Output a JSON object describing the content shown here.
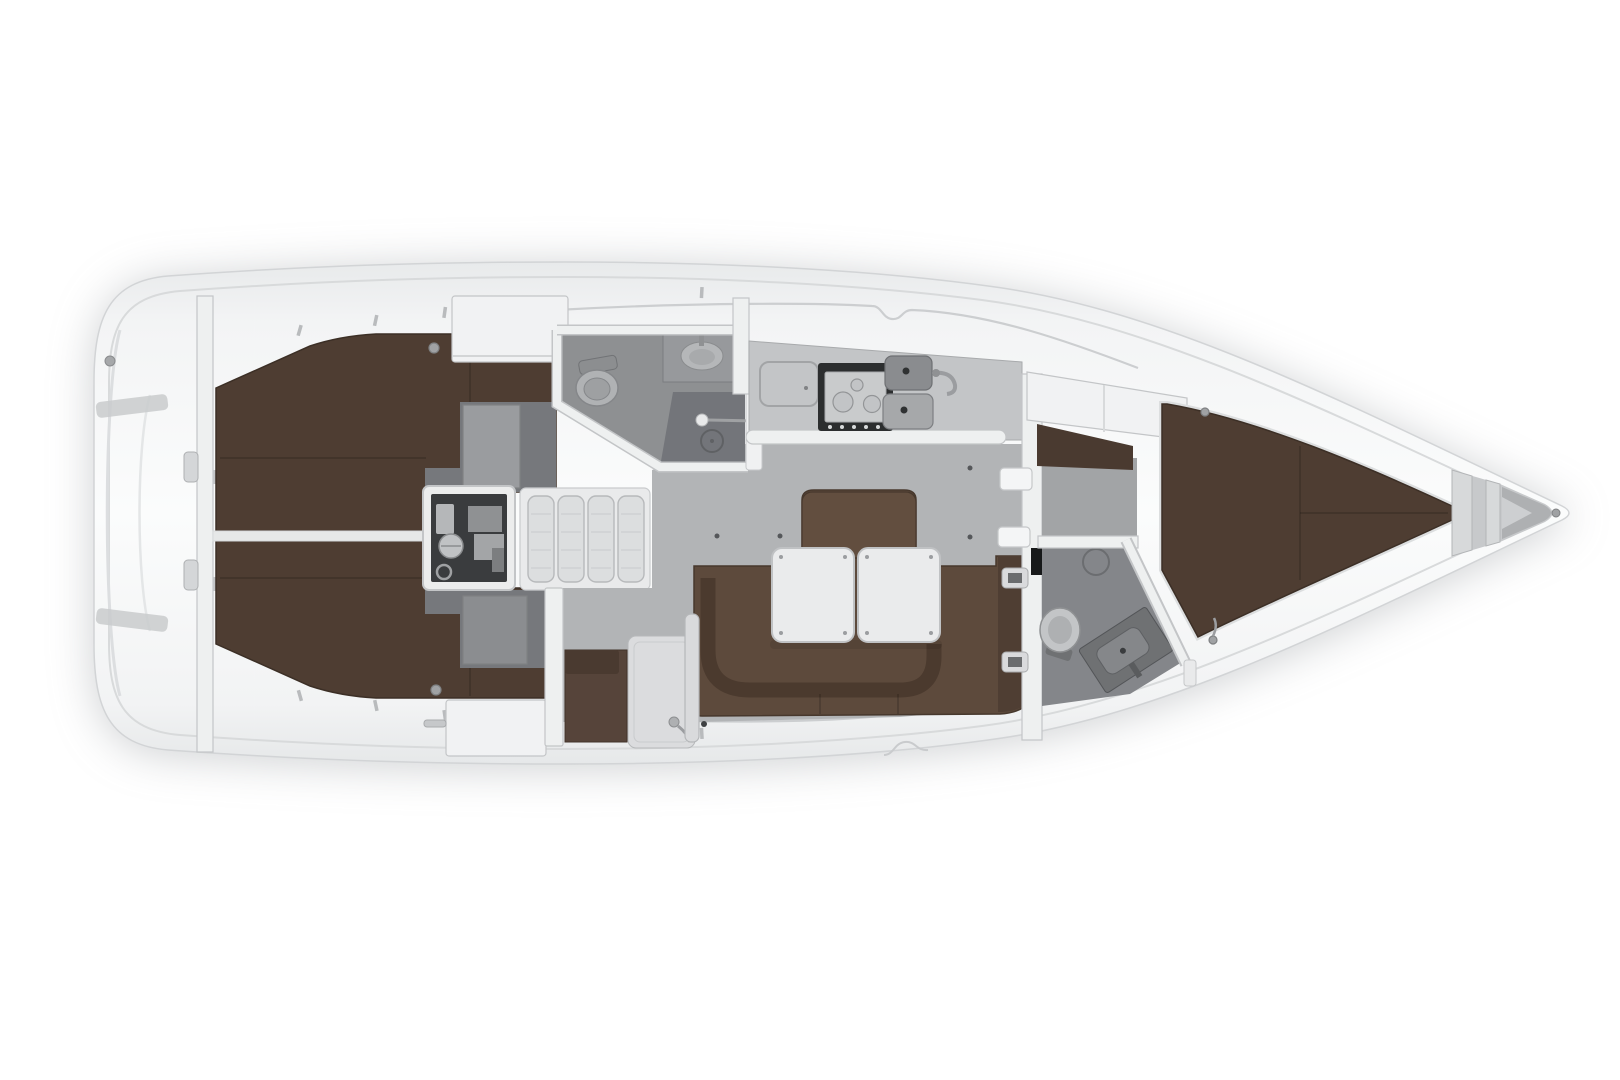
{
  "meta": {
    "description": "Top-down interior layout plan of a sailing yacht, bow pointing right, no text labels",
    "type": "yacht-interior-floor-plan"
  },
  "regions": [
    "swim-platform",
    "stern-bulkhead",
    "port-aft-cabin",
    "starboard-aft-cabin",
    "engine-compartment",
    "companionway-steps",
    "aft-head",
    "shower",
    "galley",
    "stove",
    "double-sink",
    "saloon",
    "u-settee",
    "dinette-table",
    "nav-station",
    "main-bulkhead",
    "forward-head",
    "forward-cabin",
    "v-berth",
    "anchor-locker",
    "bow-tip"
  ],
  "colors": {
    "background": "#ffffff",
    "hull_edge": "#d2d4d6",
    "inner_line": "#d8dadb",
    "deck_line": "#ccced0",
    "wall_fill": "#eef0f0",
    "wall_stroke": "#c3c5c7",
    "cabinet": "#f1f2f3",
    "berth": "#4e3d32",
    "berth_edge": "#3c2f26",
    "berth_rim": "#dcdedf",
    "divider": "#e6e8e8",
    "corridor_dark": "#76787c",
    "door_gray": "#9a9c9f",
    "door_gray2": "#8b8d90",
    "door_gray_edge": "#7f8184",
    "floor": "#b2b4b6",
    "floor_dot": "#55575a",
    "head_floor": "#8e9092",
    "shower_floor": "#73757a",
    "fixture_fill": "#b0b2b4",
    "fixture_inner": "#9ea0a2",
    "fixture_stroke": "#85878a",
    "counter": "#c3c5c7",
    "counter_edge": "#a8aaac",
    "stove_frame": "#2c2e2f",
    "stove_top": "#c9cbcc",
    "burner": "#c2c4c6",
    "sink_dark": "#8a8c8f",
    "sink_light": "#a6a8aa",
    "drain": "#2f3132",
    "engine_frame": "#eceded",
    "engine_dark": "#3a3c3e",
    "machine_light": "#b5b7b9",
    "machine_mid": "#8f9193",
    "steps_fill": "#dcdedf",
    "steps_stroke": "#b7b9bb",
    "steps_line": "#c8cacc",
    "settee": "#5d4a3c",
    "settee_dark": "#4b3a2e",
    "settee_side": "#4f3e33",
    "settee_edge": "#47382d",
    "backrest": "#624e3f",
    "table": "#eaebec",
    "table_stroke": "#c0c2c4",
    "screw": "#9b9da0",
    "bulkhead": "#eef0f0",
    "white_fitting": "#f4f5f6",
    "lamp": "#a0a2a4",
    "locker_gray": "#aeb0b2",
    "locker_light": "#cdcfd1",
    "hull_grad_edge": "#e8eaeb",
    "hull_grad_mid": "#fbfcfc"
  }
}
